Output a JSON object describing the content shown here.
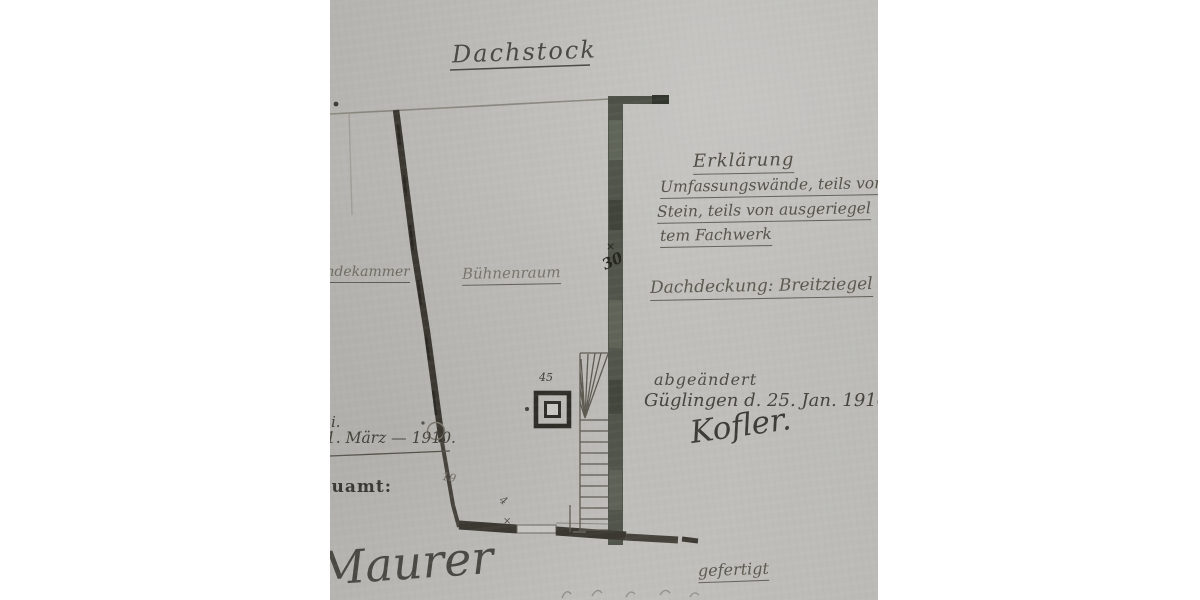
{
  "document": {
    "title": "Dachstock",
    "rooms": {
      "main": "Bühnenraum",
      "adjacent_partial": "Gesindekammer"
    },
    "legend": {
      "heading": "Erklärung",
      "line1": "Umfassungswände, teils von",
      "line2": "Stein, teils von ausgeriegel",
      "line3": "tem Fachwerk"
    },
    "roofing": "Dachdeckung: Breitziegel",
    "amendment": {
      "label": "abgeändert",
      "place_date": "Güglingen d. 25. Jan. 1916",
      "signature": "Kofler."
    },
    "left_margin": {
      "fragment": "i.",
      "date": "d. 1. März — 1910.",
      "office": "Ortsbauamt:"
    },
    "footer": {
      "signature": "Maurer",
      "prepared": "gefertigt"
    },
    "dimensions": {
      "wall_thickness": "30",
      "chimney": "45",
      "small": "19",
      "tiny": "4",
      "tick": "×"
    },
    "colors": {
      "paper": "#bcbbb7",
      "ink": "#55524a",
      "wall_dark": "#3a3831",
      "wall_green": "#50544a"
    }
  }
}
